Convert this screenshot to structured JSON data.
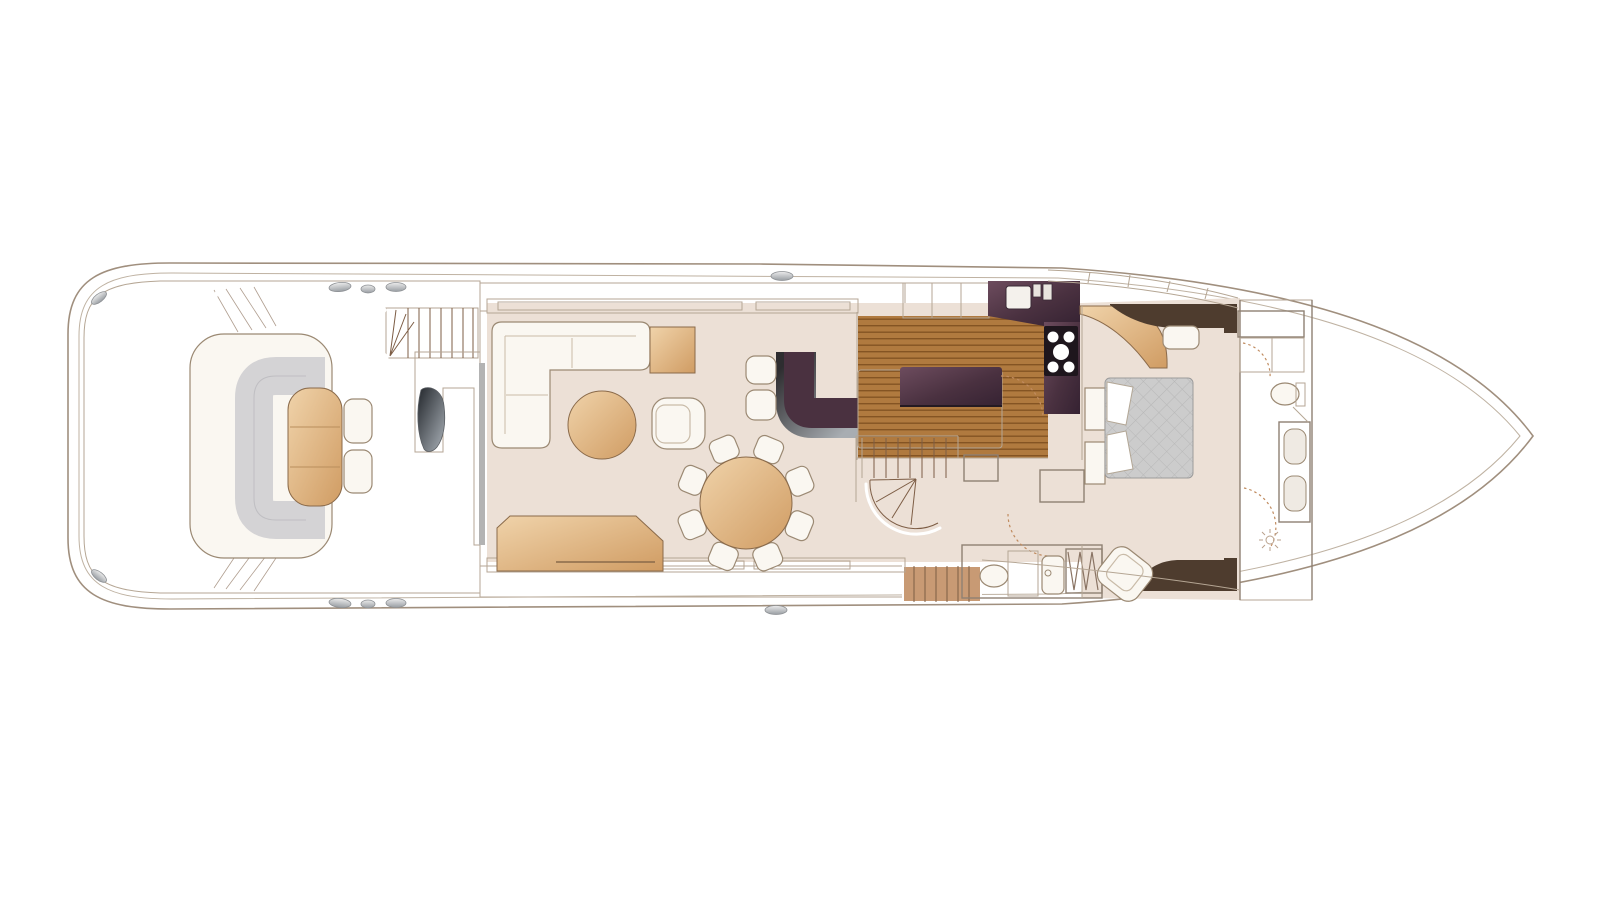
{
  "page": {
    "background": "#ffffff"
  },
  "plan": {
    "kind": "motor-yacht-main-deck-floorplan",
    "colors": {
      "hull_outline": "#a08f7e",
      "hull_inner": "#bfb2a2",
      "wall_line": "#8f8173",
      "wall_light": "#b5a694",
      "teak_base": "#c89a74",
      "teak_seam": "#8f6c50",
      "gfloor_base": "#b07a3f",
      "gfloor_seam": "#845423",
      "interior": "#ece0d6",
      "aub": "#4a3140",
      "aub_light": "#6d4c5e",
      "aub_dark": "#352232",
      "darkwood": "#4e3c2e",
      "tan_l": "#f0d3aa",
      "tan_d": "#d09c63",
      "tan_line": "#8a6a4a",
      "white_f": "#faf7f1",
      "furn_line": "#9b8973",
      "cushion": "#d4d3d5",
      "mattress": "#cccccc",
      "door": "#c08b5f",
      "tread_line": "#7d5d45",
      "rim_dark": "#2e2d30",
      "rim_light": "#a8adb2",
      "cooktop": "#1e161d"
    },
    "areas": [
      "aft-deck",
      "salon",
      "dining-area",
      "bar",
      "galley",
      "staircase",
      "corridor",
      "day-head",
      "master-cabin",
      "master-bathroom",
      "foredeck"
    ],
    "furniture": {
      "aft_deck": [
        "c-shaped-settee",
        "cocktail-table",
        "deck-chairs"
      ],
      "salon": [
        "l-shaped-sofa",
        "corner-side-table",
        "round-coffee-table",
        "armchair",
        "sideboard"
      ],
      "dining": {
        "table": "round-dining-table",
        "chairs": 8
      },
      "bar": {
        "counter": "curved-bar-counter",
        "stools": 2
      },
      "galley": [
        "worktop-with-sink",
        "five-burner-cooktop",
        "island-unit",
        "cabinets"
      ],
      "master_cabin": [
        "double-bed",
        "nightstands",
        "bench-seat",
        "armchair",
        "wardrobes"
      ],
      "master_bathroom": [
        "toilet",
        "twin-sink-vanity",
        "shower",
        "hanging-locker"
      ],
      "day_head": [
        "toilet",
        "sink",
        "hanging-locker",
        "armchair"
      ]
    }
  }
}
